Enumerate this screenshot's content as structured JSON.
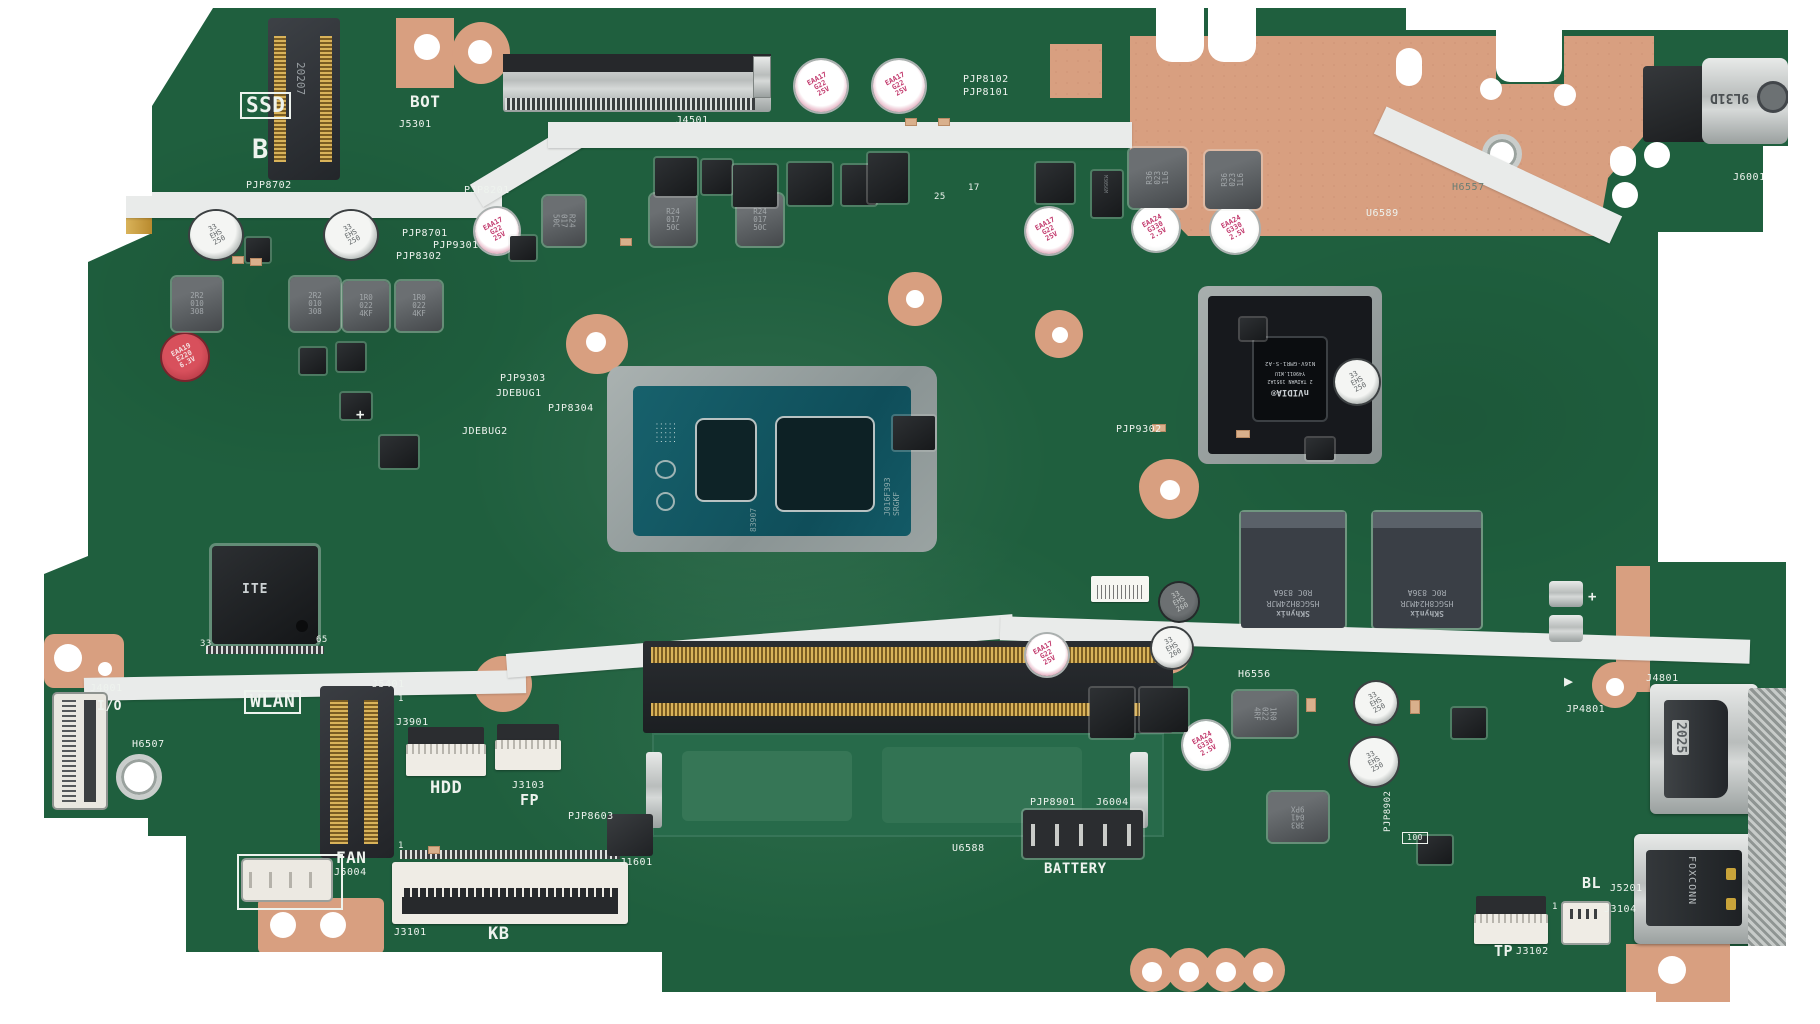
{
  "meta": {
    "description": "Photograph of an ASUS laptop motherboard on a white background"
  },
  "colors": {
    "pcb_green": "#1f5f3e",
    "copper": "#d89f80",
    "foam_white": "#e9ebea",
    "silkscreen": "#eef3ee",
    "cap_pink_print": "#c23a6d"
  },
  "silkscreen": {
    "ssd": "SSD",
    "b": "B",
    "bot": "BOT",
    "j5301": "J5301",
    "pjp8702": "PJP8702",
    "j4501": "J4501",
    "pjp8102": "PJP8102",
    "pjp8101": "PJP8101",
    "pjp8201": "PJP8201",
    "pjp8701": "PJP8701",
    "pjp9301": "PJP9301",
    "pjp8302": "PJP8302",
    "pjp9303": "PJP9303",
    "jdebug1": "JDEBUG1",
    "jdebug2": "JDEBUG2",
    "pjp8304": "PJP8304",
    "plus": "+",
    "pjp9302": "PJP9302",
    "u6589": "U6589",
    "h6557": "H6557",
    "j6001": "J6001",
    "h6556": "H6556",
    "wlan": "WLAN",
    "j5401": "J5401",
    "j3901": "J3901",
    "hdd": "HDD",
    "j3103": "J3103",
    "fp": "FP",
    "pjp8603": "PJP8603",
    "j4001": "J4001",
    "io": "I/O",
    "h6507": "H6507",
    "fan": "FAN",
    "j5004": "J5004",
    "j3101": "J3101",
    "kb": "KB",
    "j1601": "J1601",
    "battery": "BATTERY",
    "pjp8901": "PJP8901",
    "j6004": "J6004",
    "u6588": "U6588",
    "bl": "BL",
    "j5201": "J5201",
    "j3104": "J3104",
    "tp": "TP",
    "j3102": "J3102",
    "j4801": "J4801",
    "jp4801": "JP4801",
    "pjp8902": "PJP8902",
    "r100": "100",
    "n33": "33",
    "n65": "65",
    "n17": "17",
    "n25": "25",
    "pin1": "1",
    "arrow": "▶"
  },
  "chips": {
    "cpu_marking": "J016F393 SRGKF",
    "cpu_code": "83907",
    "gpu_brand": "nVIDIA®",
    "gpu_origin": "2 TAIWAN 1951A2",
    "gpu_lot": "Y49011.W1U",
    "gpu_model": "N16V-GMR1-S-A2",
    "vram_brand": "SKhynix",
    "vram_model": "H5GC8H24MJR",
    "vram_lot": "R0C  836A",
    "ec_brand": "ITE",
    "ssd_slot_marking": "20207",
    "dc_jack_marking": "9L31D",
    "hdmi_port_marking": "2025",
    "usb_port_marking": "FOXCONN",
    "mosfet_marking": "M3056M"
  },
  "caps": {
    "silver_250": "33\nEHS\n250",
    "silver_260": "33\nEHS\n260",
    "pink_25v": "EAA17\nG22\n25V",
    "white_2v5": "EAA24\nG330\n2.5V",
    "red_6v3": "EAA19\nE220\n6.3V"
  },
  "inductors": {
    "l_2r2": "2R2\n010\n308",
    "l_1r0": "1R0\n022\n4KF",
    "l_r24": "R24\n017\n50C",
    "l_r36": "R36\n023\n1L6",
    "l_1r0b": "1R0\n022\n4RF",
    "l_3r3": "3R3\n041\n9PX"
  }
}
